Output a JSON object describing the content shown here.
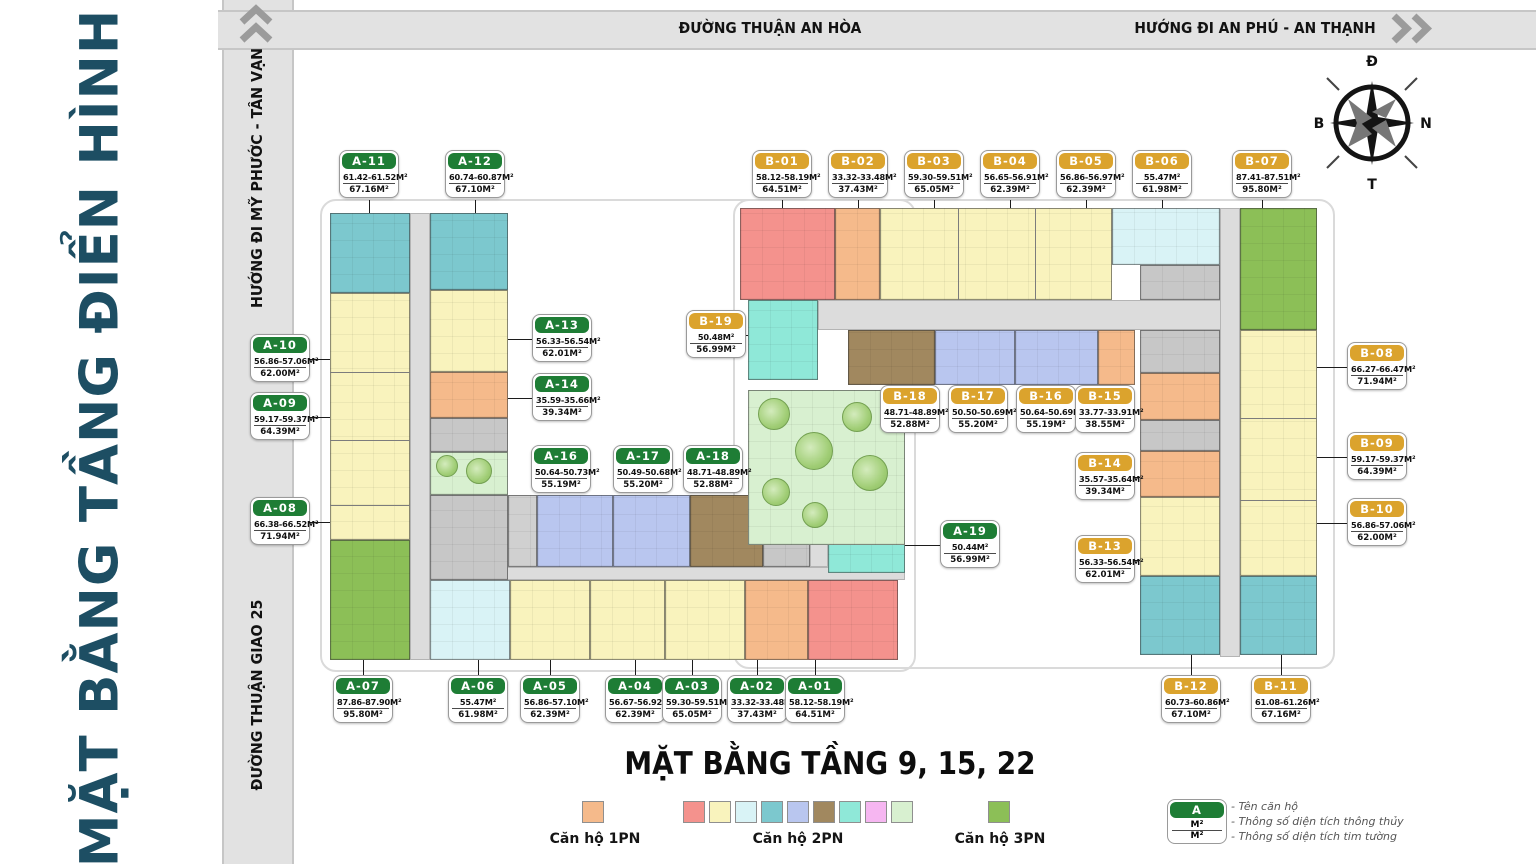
{
  "title": "MẶT BẰNG TẦNG ĐIỂN HÌNH",
  "caption": "MẶT BẰNG TẦNG 9, 15, 22",
  "roads": {
    "top": "ĐƯỜNG THUẬN AN HÒA",
    "top_right": "HƯỚNG ĐI AN PHÚ - AN THẠNH",
    "left_upper": "HƯỚNG ĐI MỸ PHƯỚC - TÂN VẠN",
    "left_lower": "ĐƯỜNG THUẬN GIAO 25"
  },
  "compass": {
    "top": "Đ",
    "left": "B",
    "right": "N",
    "bottom": "T"
  },
  "colors": {
    "a_header": "#1e7d35",
    "b_header": "#dba32d",
    "pn1": [
      "#f5ba8b"
    ],
    "pn2": [
      "#f4928d",
      "#f9f3bd",
      "#d9f3f6",
      "#7cc8ce",
      "#b9c6ef",
      "#a1885f",
      "#8fe8d8",
      "#f6b6f1",
      "#d8f0d0"
    ],
    "pn3": [
      "#8cbf57"
    ]
  },
  "legend": {
    "pn1_label": "Căn hộ 1PN",
    "pn2_label": "Căn hộ 2PN",
    "pn3_label": "Căn hộ 3PN",
    "key": {
      "name": "A",
      "net": "M²",
      "gross": "M²",
      "note1": "- Tên căn hộ",
      "note2": "- Thông số diện tích thông thủy",
      "note3": "- Thông số diện tích tim tường"
    }
  },
  "units": {
    "A-01": {
      "name": "A-01",
      "net": "58.12-58.19M²",
      "gross": "64.51M²"
    },
    "A-02": {
      "name": "A-02",
      "net": "33.32-33.48M²",
      "gross": "37.43M²"
    },
    "A-03": {
      "name": "A-03",
      "net": "59.30-59.51M²",
      "gross": "65.05M²"
    },
    "A-04": {
      "name": "A-04",
      "net": "56.67-56.92M²",
      "gross": "62.39M²"
    },
    "A-05": {
      "name": "A-05",
      "net": "56.86-57.10M²",
      "gross": "62.39M²"
    },
    "A-06": {
      "name": "A-06",
      "net": "55.47M²",
      "gross": "61.98M²"
    },
    "A-07": {
      "name": "A-07",
      "net": "87.86-87.90M²",
      "gross": "95.80M²"
    },
    "A-08": {
      "name": "A-08",
      "net": "66.38-66.52M²",
      "gross": "71.94M²"
    },
    "A-09": {
      "name": "A-09",
      "net": "59.17-59.37M²",
      "gross": "64.39M²"
    },
    "A-10": {
      "name": "A-10",
      "net": "56.86-57.06M²",
      "gross": "62.00M²"
    },
    "A-11": {
      "name": "A-11",
      "net": "61.42-61.52M²",
      "gross": "67.16M²"
    },
    "A-12": {
      "name": "A-12",
      "net": "60.74-60.87M²",
      "gross": "67.10M²"
    },
    "A-13": {
      "name": "A-13",
      "net": "56.33-56.54M²",
      "gross": "62.01M²"
    },
    "A-14": {
      "name": "A-14",
      "net": "35.59-35.66M²",
      "gross": "39.34M²"
    },
    "A-16": {
      "name": "A-16",
      "net": "50.64-50.73M²",
      "gross": "55.19M²"
    },
    "A-17": {
      "name": "A-17",
      "net": "50.49-50.68M²",
      "gross": "55.20M²"
    },
    "A-18": {
      "name": "A-18",
      "net": "48.71-48.89M²",
      "gross": "52.88M²"
    },
    "A-19": {
      "name": "A-19",
      "net": "50.44M²",
      "gross": "56.99M²"
    },
    "B-01": {
      "name": "B-01",
      "net": "58.12-58.19M²",
      "gross": "64.51M²"
    },
    "B-02": {
      "name": "B-02",
      "net": "33.32-33.48M²",
      "gross": "37.43M²"
    },
    "B-03": {
      "name": "B-03",
      "net": "59.30-59.51M²",
      "gross": "65.05M²"
    },
    "B-04": {
      "name": "B-04",
      "net": "56.65-56.91M²",
      "gross": "62.39M²"
    },
    "B-05": {
      "name": "B-05",
      "net": "56.86-56.97M²",
      "gross": "62.39M²"
    },
    "B-06": {
      "name": "B-06",
      "net": "55.47M²",
      "gross": "61.98M²"
    },
    "B-07": {
      "name": "B-07",
      "net": "87.41-87.51M²",
      "gross": "95.80M²"
    },
    "B-08": {
      "name": "B-08",
      "net": "66.27-66.47M²",
      "gross": "71.94M²"
    },
    "B-09": {
      "name": "B-09",
      "net": "59.17-59.37M²",
      "gross": "64.39M²"
    },
    "B-10": {
      "name": "B-10",
      "net": "56.86-57.06M²",
      "gross": "62.00M²"
    },
    "B-11": {
      "name": "B-11",
      "net": "61.08-61.26M²",
      "gross": "67.16M²"
    },
    "B-12": {
      "name": "B-12",
      "net": "60.73-60.86M²",
      "gross": "67.10M²"
    },
    "B-13": {
      "name": "B-13",
      "net": "56.33-56.54M²",
      "gross": "62.01M²"
    },
    "B-14": {
      "name": "B-14",
      "net": "35.57-35.64M²",
      "gross": "39.34M²"
    },
    "B-15": {
      "name": "B-15",
      "net": "33.77-33.91M²",
      "gross": "38.55M²"
    },
    "B-16": {
      "name": "B-16",
      "net": "50.64-50.69M²",
      "gross": "55.19M²"
    },
    "B-17": {
      "name": "B-17",
      "net": "50.50-50.69M²",
      "gross": "55.20M²"
    },
    "B-18": {
      "name": "B-18",
      "net": "48.71-48.89M²",
      "gross": "52.88M²"
    },
    "B-19": {
      "name": "B-19",
      "net": "50.48M²",
      "gross": "56.99M²"
    }
  }
}
